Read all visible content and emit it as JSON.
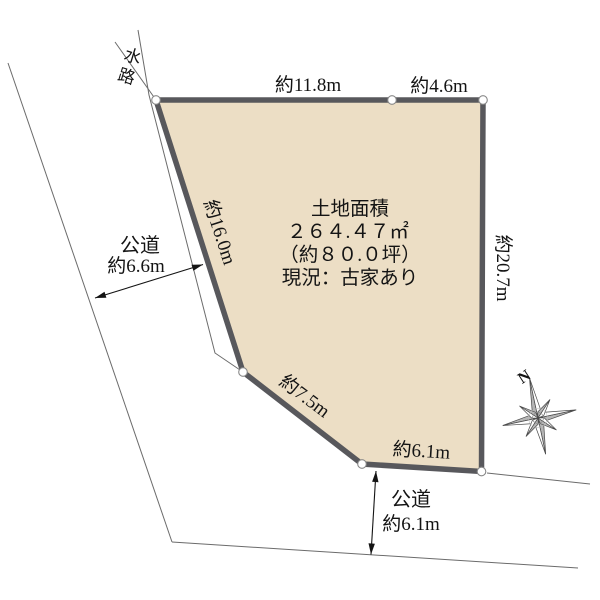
{
  "plot": {
    "area_title": "土地面積",
    "area_m2": "２６４.４７㎡",
    "area_tsubo": "（約８０.０坪）",
    "status": "現況：古家あり"
  },
  "edges": {
    "top_left": "約11.8m",
    "top_right": "約4.6m",
    "right": "約20.7m",
    "bottom": "約6.1m",
    "diagonal": "約7.5m",
    "left": "約16.0m"
  },
  "surroundings": {
    "waterway_label": "水路",
    "road_left_name": "公道",
    "road_left_width": "約6.6m",
    "road_bottom_name": "公道",
    "road_bottom_width": "約6.1m"
  },
  "compass": {
    "north_label": "N"
  },
  "colors": {
    "plot_fill": "#ecdec5",
    "plot_border": "#58585c",
    "thin_line": "#6b6b6b",
    "text": "#141414",
    "vertex_fill": "#ffffff",
    "vertex_stroke": "#888888"
  }
}
